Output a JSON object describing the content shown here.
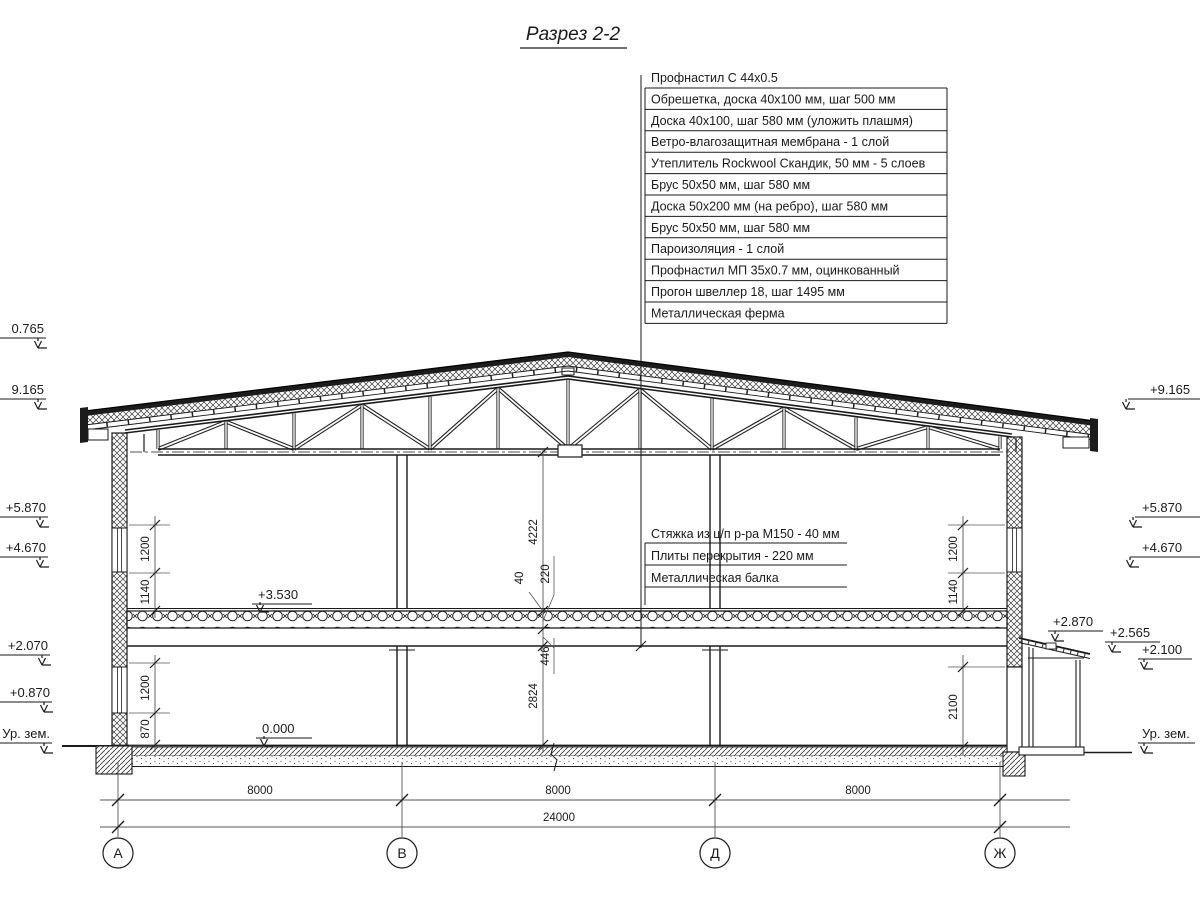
{
  "title": "Разрез 2-2",
  "roof_callouts": [
    "Профнастил С 44х0.5",
    "Обрешетка, доска 40х100 мм, шаг 500 мм",
    "Доска 40х100, шаг 580 мм (уложить плашмя)",
    "Ветро-влагозащитная мембрана - 1 слой",
    "Утеплитель Rockwool Скандик, 50 мм - 5 слоев",
    "Брус 50х50 мм, шаг 580 мм",
    "Доска 50х200 мм (на ребро), шаг 580 мм",
    "Брус 50х50 мм, шаг 580 мм",
    "Пароизоляция - 1 слой",
    "Профнастил МП 35х0.7 мм, оцинкованный",
    "Прогон швеллер 18, шаг 1495 мм",
    "Металлическая ферма"
  ],
  "floor_callouts": [
    "Стяжка из ц/п р-ра М150 - 40 мм",
    "Плиты перекрытия - 220 мм",
    "Металлическая балка"
  ],
  "elevations": {
    "left": [
      "0.765",
      "9.165",
      "+5.870",
      "+4.670",
      "+2.070",
      "+0.870",
      "Ур. зем."
    ],
    "right": [
      "+9.165",
      "+5.870",
      "+4.670",
      "+2.870",
      "+2.565",
      "+2.100",
      "Ур. зем."
    ],
    "floor_upper": "+3.530",
    "floor_lower": "0.000"
  },
  "dims": {
    "center": [
      "4222",
      "40",
      "220",
      "446",
      "2824"
    ],
    "left": [
      "1200",
      "1140",
      "1200",
      "870"
    ],
    "right": [
      "1200",
      "1140",
      "2100"
    ],
    "spans": [
      "8000",
      "8000",
      "8000"
    ],
    "total": "24000"
  },
  "axes": [
    "А",
    "В",
    "Д",
    "Ж"
  ]
}
